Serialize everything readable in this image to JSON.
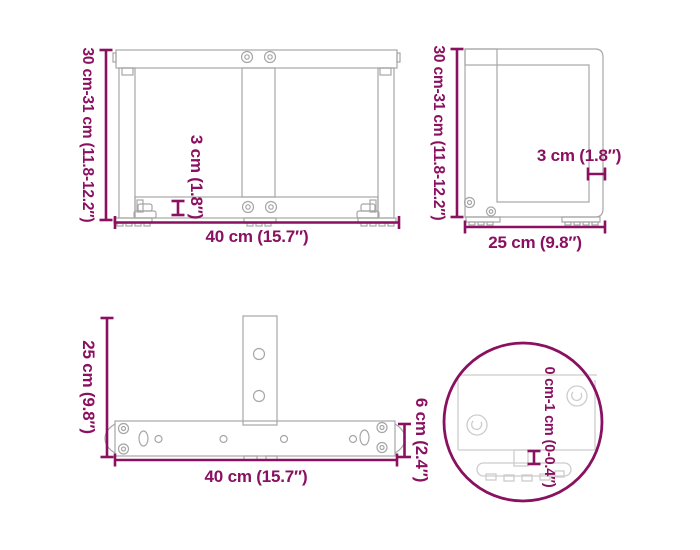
{
  "colors": {
    "accent": "#8a1060",
    "drawing_gray": "#a6a6a6",
    "detail_gray": "#cccccc",
    "background": "#ffffff"
  },
  "views": {
    "front": {
      "height_label": "30 cm-31 cm (11.8-12.2″)",
      "width_label": "40 cm (15.7″)",
      "thickness_label": "3 cm (1.8″)"
    },
    "side": {
      "height_label": "30 cm-31 cm (11.8-12.2″)",
      "depth_label": "25 cm (9.8″)",
      "thickness_label": "3 cm (1.8″)"
    },
    "top": {
      "depth_label": "25 cm (9.8″)",
      "width_label": "40 cm (15.7″)",
      "bar_height_label": "6 cm (2.4″)"
    },
    "detail": {
      "adjustment_label": "0 cm-1 cm (0-0.4″)"
    }
  }
}
